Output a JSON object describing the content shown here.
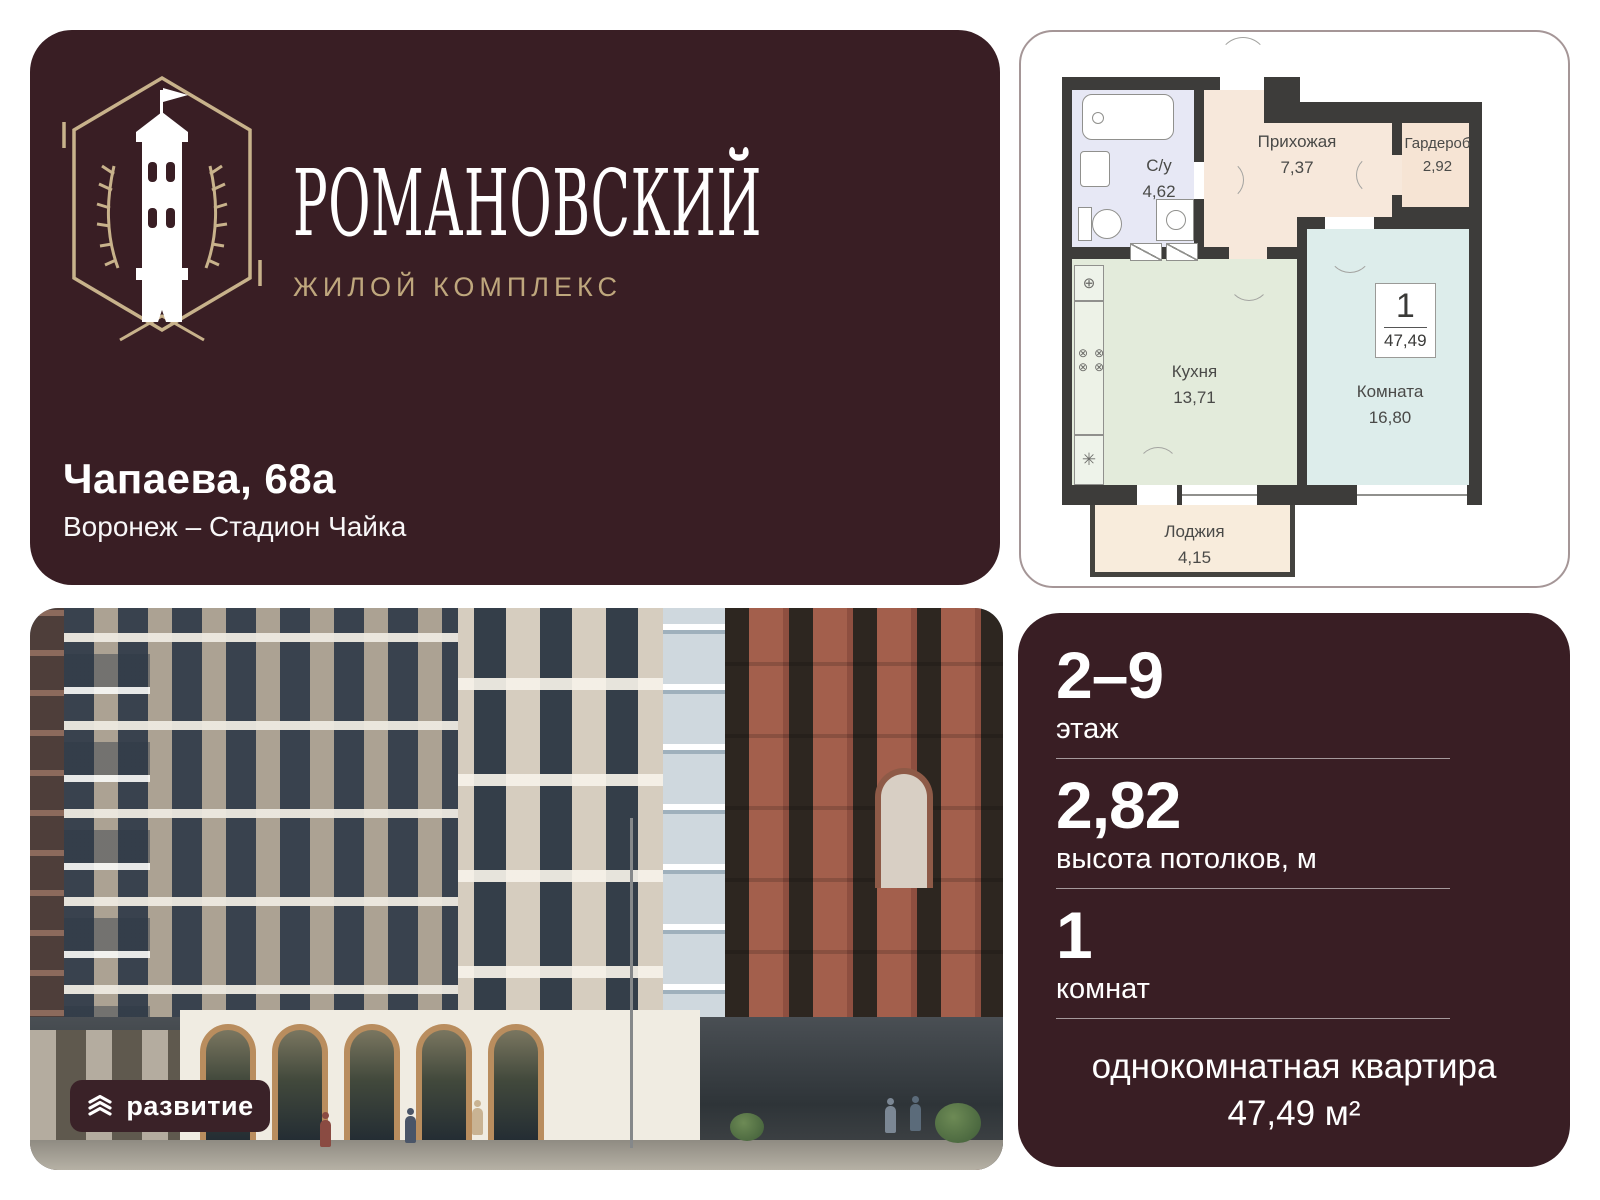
{
  "brand": {
    "name": "РОМАНОВСКИЙ",
    "subtitle": "ЖИЛОЙ КОМПЛЕКС",
    "address_line1": "Чапаева, 68а",
    "address_line2": "Воронеж – Стадион Чайка"
  },
  "developer": {
    "label": "развитие"
  },
  "floorplan": {
    "unit": {
      "number": "1",
      "area": "47,49"
    },
    "rooms": [
      {
        "name": "С/у",
        "area": "4,62"
      },
      {
        "name": "Прихожая",
        "area": "7,37"
      },
      {
        "name": "Гардероб",
        "area": "2,92"
      },
      {
        "name": "Кухня",
        "area": "13,71"
      },
      {
        "name": "Комната",
        "area": "16,80"
      },
      {
        "name": "Лоджия",
        "area": "4,15"
      }
    ]
  },
  "specs": [
    {
      "value": "2–9",
      "label": "этаж"
    },
    {
      "value": "2,82",
      "label": "высота потолков, м"
    },
    {
      "value": "1",
      "label": "комнат"
    }
  ],
  "summary": {
    "line1": "однокомнатная квартира",
    "line2": "47,49 м²"
  },
  "colors": {
    "brand_maroon": "#391e24",
    "brand_tan": "#bfa77d",
    "logo_line": "#c8b28b",
    "plan_wall": "#3d3c3a",
    "bathroom_fill": "#e7e8f5",
    "hallway_fill": "#f7e8db",
    "wardrobe_fill": "#f6e4d4",
    "kitchen_fill": "#e3ebdb",
    "room_fill": "#ddedeb",
    "loggia_fill": "#f8ecdc",
    "arch_bronze": "#b98d5e",
    "brick": "#a35f4c"
  }
}
